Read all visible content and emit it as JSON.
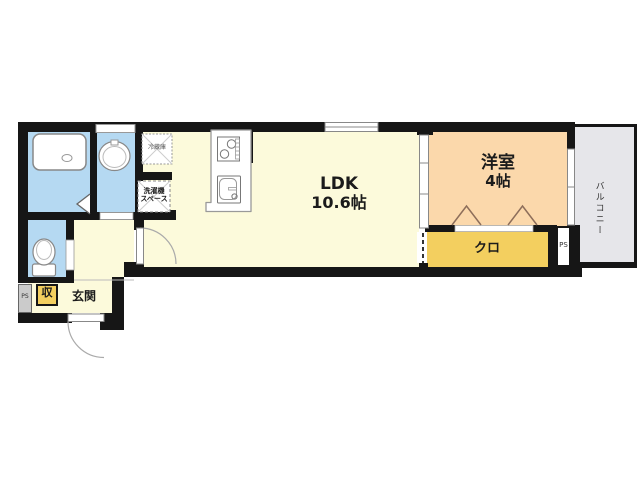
{
  "plan_type": "floor-plan",
  "labels": {
    "ldk": {
      "name": "LDK",
      "size": "10.6帖"
    },
    "western_room": {
      "name": "洋室",
      "size": "4帖"
    },
    "closet": "クロ",
    "entrance": "玄関",
    "storage": "収",
    "balcony": "バルコニー",
    "refrigerator": "冷蔵庫",
    "laundry_line1": "洗濯機",
    "laundry_line2": "スペース",
    "pipe_space_left": "PS",
    "pipe_space_right": "PS"
  },
  "colors": {
    "wall": "#161616",
    "floor_yellow": "#fcfadb",
    "western_room_peach": "#fbd8ab",
    "closet_gold": "#f3cf5f",
    "wet_area_blue": "#b5d9f2",
    "balcony_gray": "#e6e6ea",
    "pipe_space_gray": "#cbcbcb"
  }
}
